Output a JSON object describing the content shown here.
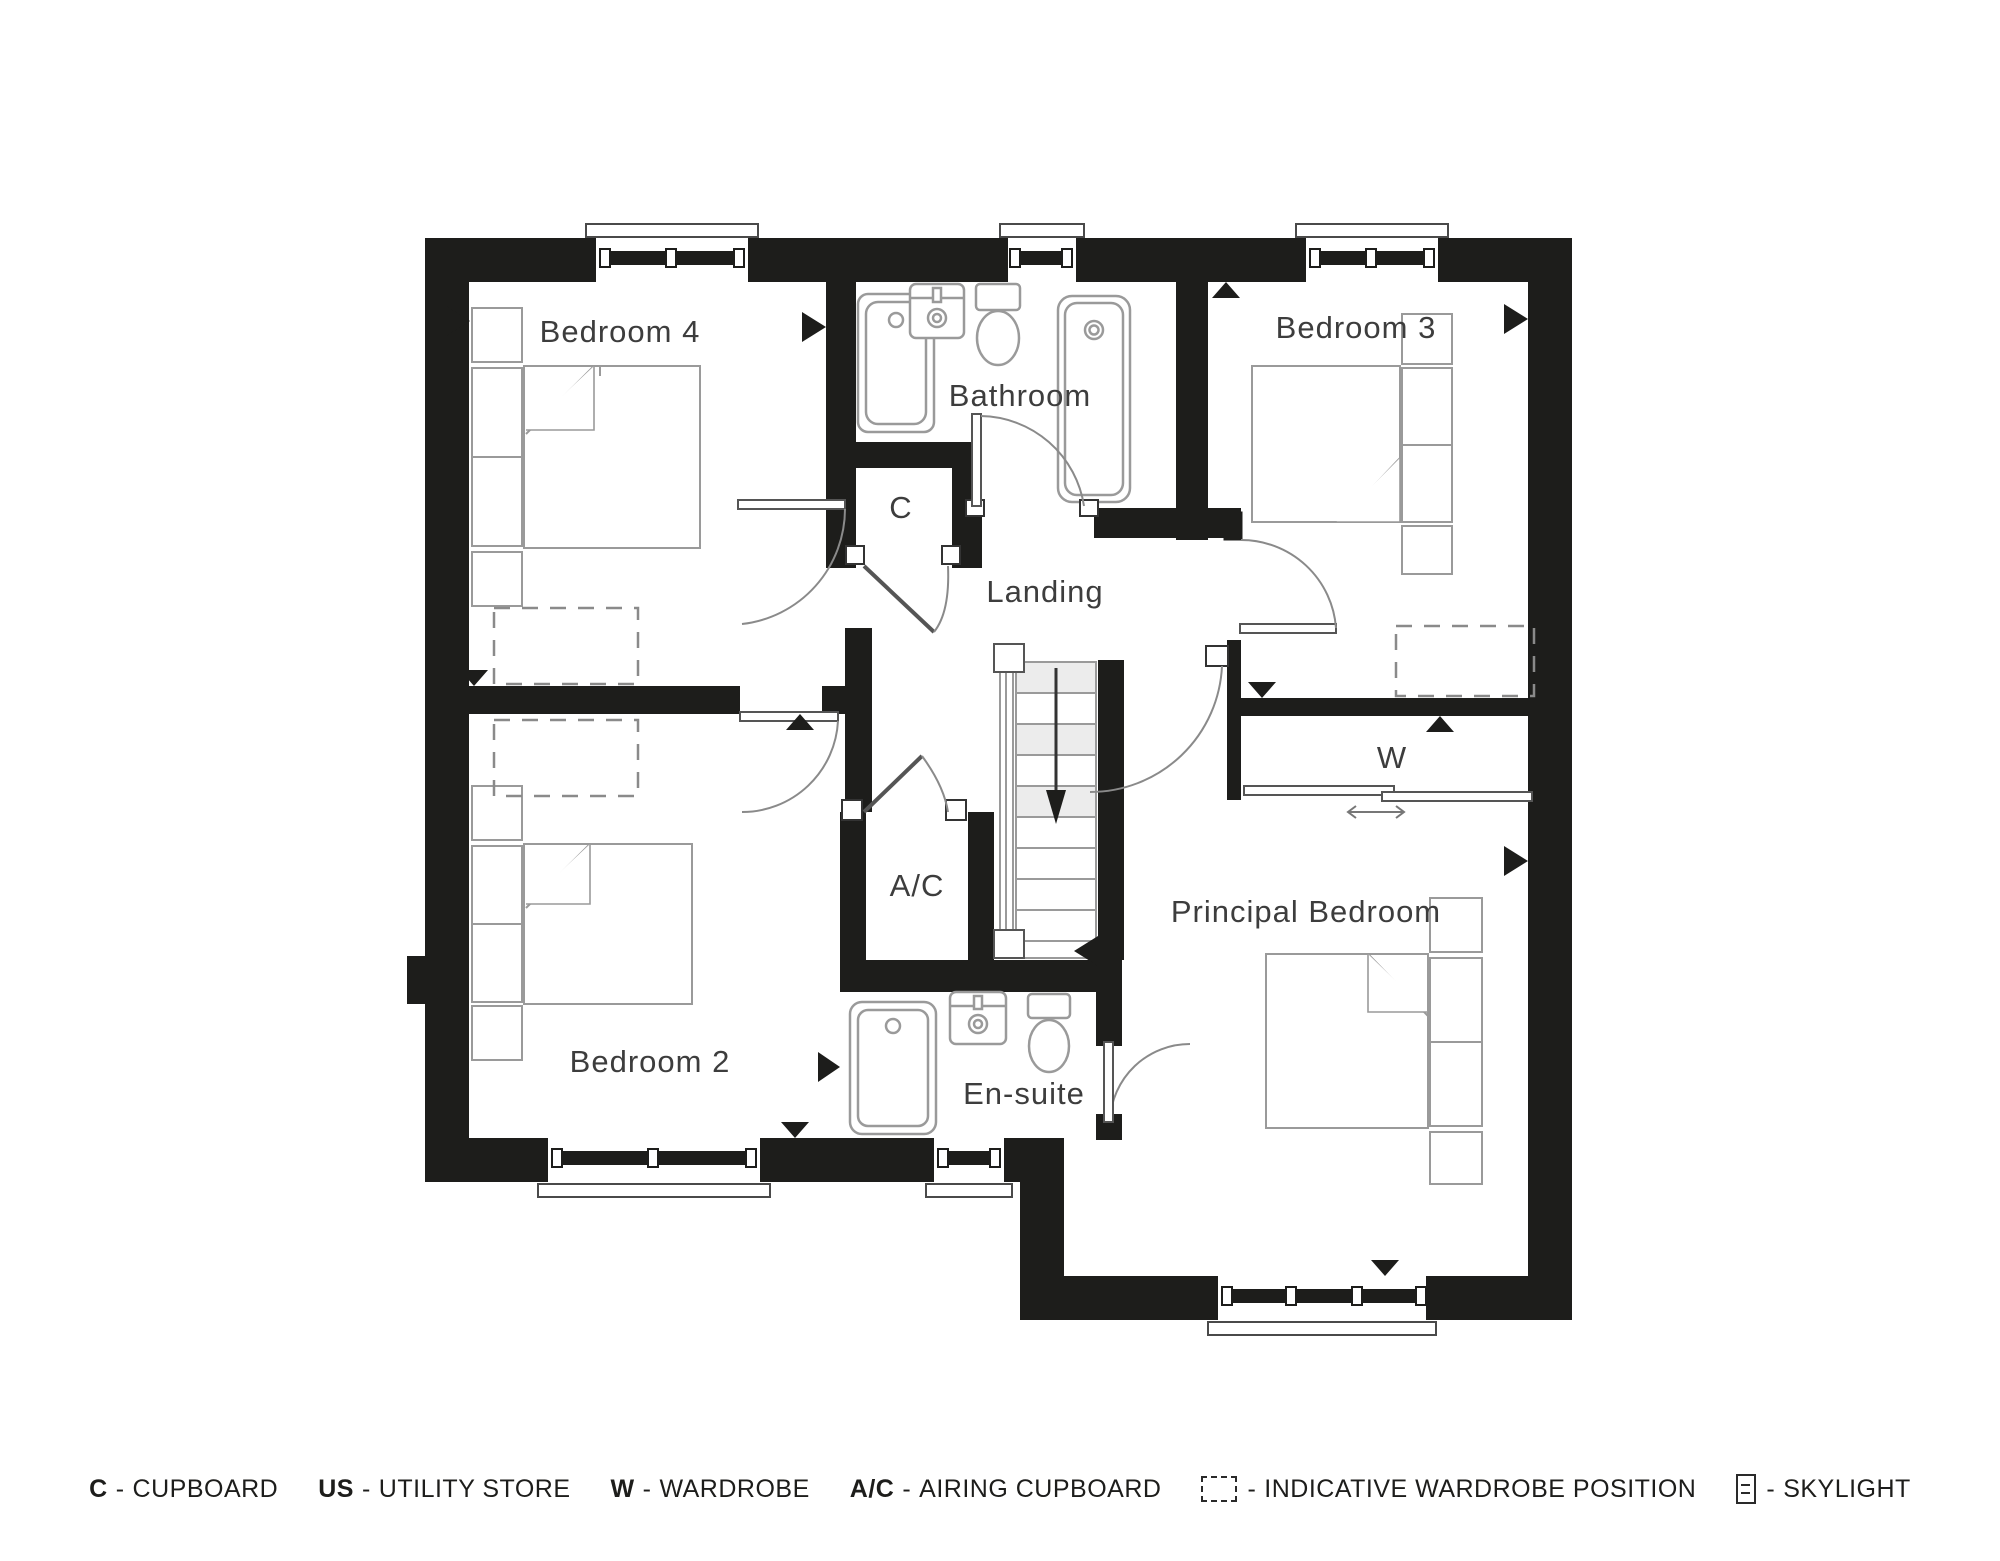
{
  "colors": {
    "wall": "#1d1d1b",
    "fixture": "#9a9a9a",
    "text": "#3d3d3d"
  },
  "labels": {
    "bedroom4": "Bedroom 4",
    "bathroom": "Bathroom",
    "bedroom3": "Bedroom 3",
    "landing": "Landing",
    "cupboard": "C",
    "airing_cupboard": "A/C",
    "wardrobe": "W",
    "bedroom2": "Bedroom 2",
    "ensuite": "En-suite",
    "principal": "Principal Bedroom"
  },
  "legend": {
    "items": [
      {
        "key": "C",
        "sep": "-",
        "label": "CUPBOARD"
      },
      {
        "key": "US",
        "sep": "-",
        "label": "UTILITY STORE"
      },
      {
        "key": "W",
        "sep": "-",
        "label": "WARDROBE"
      },
      {
        "key": "A/C",
        "sep": "-",
        "label": "AIRING CUPBOARD"
      },
      {
        "icon": "wardrobe-position-icon",
        "sep": "-",
        "label": "INDICATIVE WARDROBE POSITION"
      },
      {
        "icon": "skylight-icon",
        "sep": "-",
        "label": "SKYLIGHT"
      }
    ]
  }
}
